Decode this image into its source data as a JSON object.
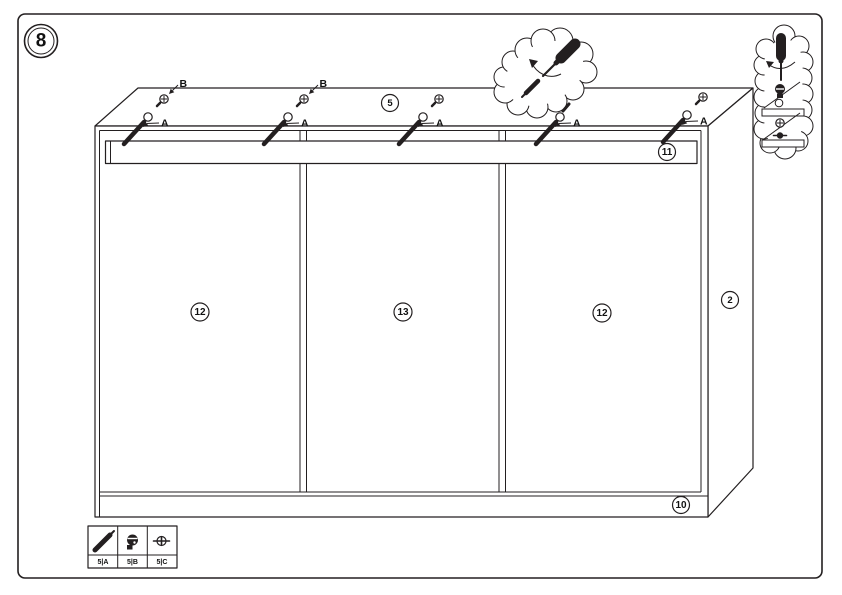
{
  "page": {
    "background": "#ffffff",
    "line_color": "#231f20",
    "description": "Furniture assembly instruction - step 8: fixing top rail of three-door wardrobe with cam bolts and screwdriver"
  },
  "step_badge": {
    "number": "8"
  },
  "parts": {
    "top_panel": {
      "label": "5"
    },
    "top_rail": {
      "label": "11"
    },
    "side_panel": {
      "label": "2"
    },
    "bottom_rail": {
      "label": "10"
    },
    "left_door": {
      "label": "12"
    },
    "middle_door": {
      "label": "13"
    },
    "right_door": {
      "label": "12"
    }
  },
  "fastener_callouts": {
    "screw_point_label": "A",
    "cam_point_label": "B"
  },
  "hardware_legend": {
    "items": [
      {
        "icon": "screw-icon",
        "label": "5|A"
      },
      {
        "icon": "cam-lock-icon",
        "label": "5|B"
      },
      {
        "icon": "cam-bolt-icon",
        "label": "5|C"
      }
    ]
  }
}
